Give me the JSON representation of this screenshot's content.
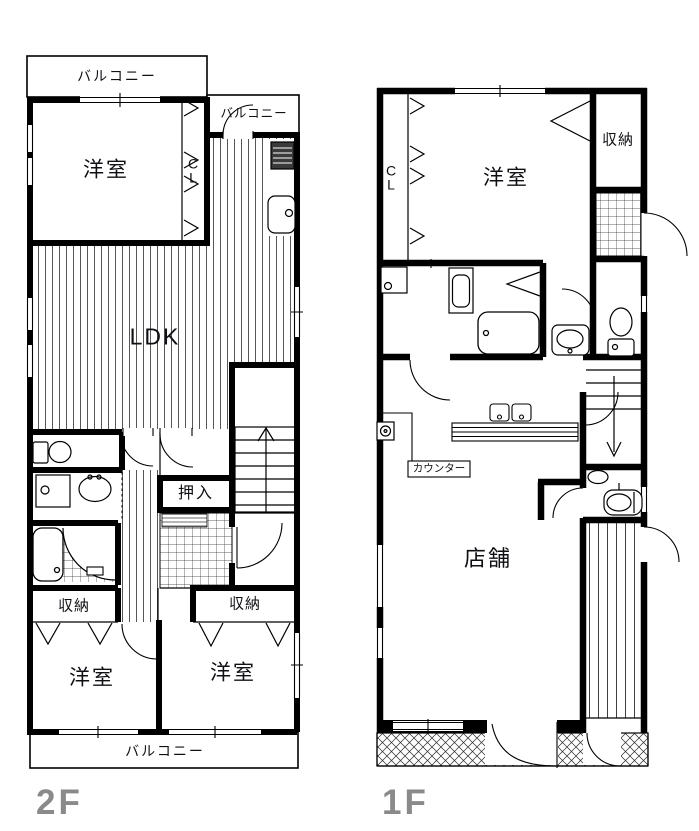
{
  "page": {
    "background": "#ffffff",
    "line_color": "#000000",
    "floor_label_color": "#8a8a8a"
  },
  "floor_plans": {
    "second_floor": {
      "floor_label": "2F",
      "rooms": {
        "balcony_top": "バルコニー",
        "balcony_kitchen": "バルコニー",
        "bedroom_nw": "洋室",
        "closet_cl": "C\nL",
        "ldk": "LDK",
        "oshiire": "押入",
        "storage_left": "収納",
        "storage_right": "収納",
        "bedroom_sw": "洋室",
        "bedroom_se": "洋室",
        "balcony_bottom": "バルコニー"
      }
    },
    "first_floor": {
      "floor_label": "1F",
      "rooms": {
        "closet_cl": "C\nL",
        "bedroom": "洋室",
        "storage": "収納",
        "counter": "カウンター",
        "shop": "店舗"
      }
    }
  }
}
